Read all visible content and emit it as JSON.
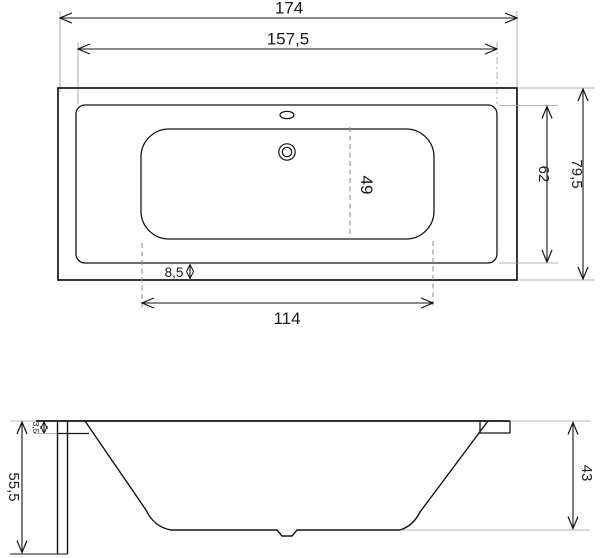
{
  "drawing": {
    "top_view": {
      "overall_length": "174",
      "rim_inner_length": "157,5",
      "rim_inner_width": "62",
      "overall_width": "79,5",
      "basin_center_line": "49",
      "rim_border_width": "8,5",
      "basin_length": "114"
    },
    "side_view": {
      "overall_height": "55,5",
      "rim_thickness": "3,5",
      "basin_depth": "43"
    }
  }
}
